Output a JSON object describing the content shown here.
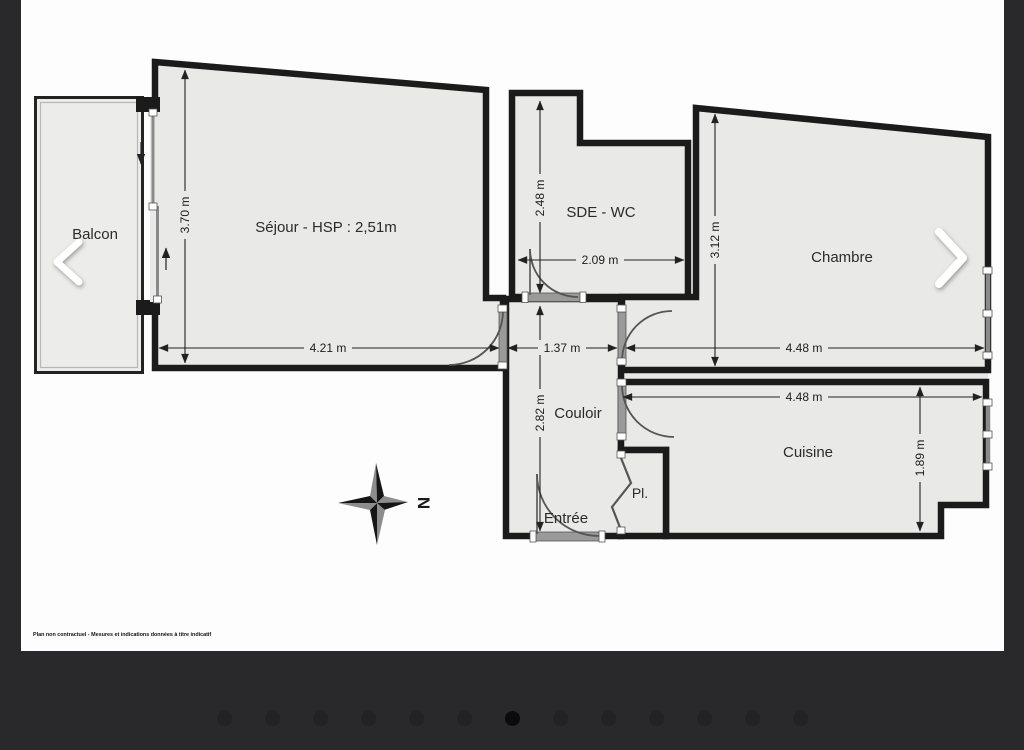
{
  "viewer": {
    "nav": {
      "prev_icon": "chevron-left",
      "next_icon": "chevron-right"
    },
    "carousel": {
      "dot_count": 13,
      "active_index": 6
    }
  },
  "plan": {
    "rooms": [
      {
        "id": "balcon",
        "label": "Balcon"
      },
      {
        "id": "sejour",
        "label": "Séjour - HSP : 2,51m"
      },
      {
        "id": "sde-wc",
        "label": "SDE - WC"
      },
      {
        "id": "chambre",
        "label": "Chambre"
      },
      {
        "id": "couloir",
        "label": "Couloir"
      },
      {
        "id": "cuisine",
        "label": "Cuisine"
      },
      {
        "id": "entree",
        "label": "Entrée"
      },
      {
        "id": "placard",
        "label": "Pl."
      }
    ],
    "dimensions": [
      {
        "room": "sejour",
        "label": "3.70 m",
        "orientation": "vertical"
      },
      {
        "room": "sejour",
        "label": "4.21 m",
        "orientation": "horizontal"
      },
      {
        "room": "sde-wc",
        "label": "2.48 m",
        "orientation": "vertical"
      },
      {
        "room": "sde-wc",
        "label": "2.09 m",
        "orientation": "horizontal"
      },
      {
        "room": "chambre",
        "label": "3.12 m",
        "orientation": "vertical"
      },
      {
        "room": "chambre",
        "label": "4.48 m",
        "orientation": "horizontal"
      },
      {
        "room": "couloir",
        "label": "1.37 m",
        "orientation": "horizontal"
      },
      {
        "room": "couloir",
        "label": "2.82 m",
        "orientation": "vertical"
      },
      {
        "room": "cuisine",
        "label": "4.48 m",
        "orientation": "horizontal"
      },
      {
        "room": "cuisine",
        "label": "1.89 m",
        "orientation": "vertical"
      }
    ],
    "compass": {
      "label": "N",
      "icon": "compass-rose"
    },
    "disclaimer": "Plan non contractuel - Mesures et indications données à titre indicatif",
    "colors": {
      "paper": "#fdfdfd",
      "floor": "#e9e9e8",
      "wall": "#1b1b1b",
      "frame": "#29292b"
    }
  }
}
